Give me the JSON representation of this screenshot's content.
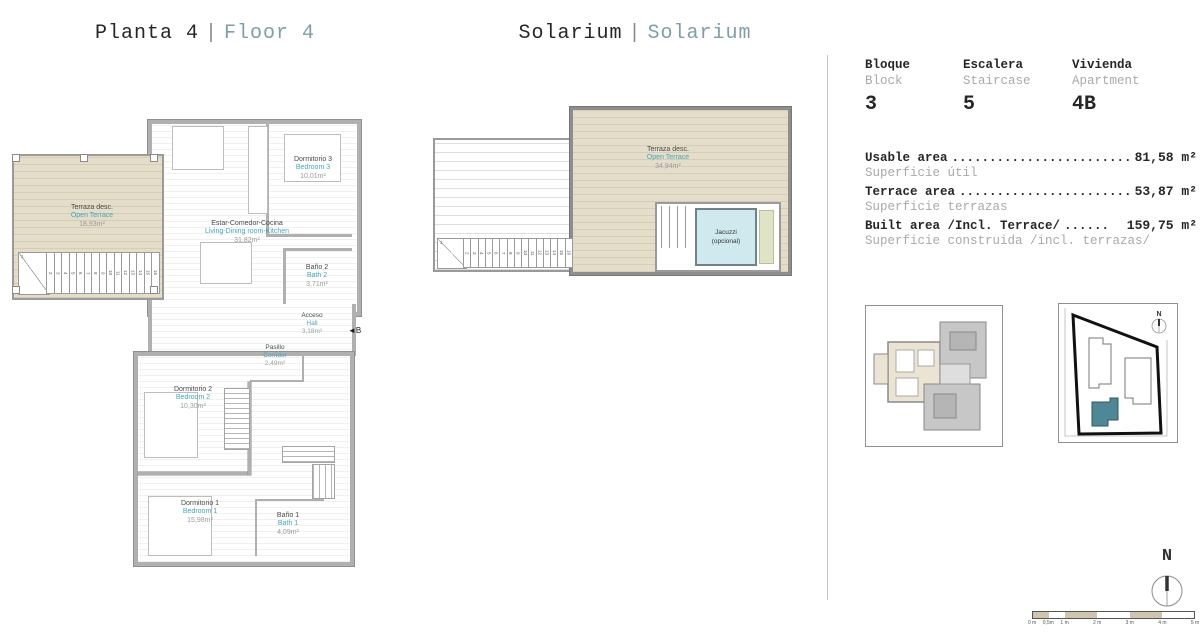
{
  "titles": {
    "floor": {
      "es": "Planta 4",
      "sep": "|",
      "en": "Floor 4"
    },
    "solarium": {
      "es": "Solarium",
      "sep": "|",
      "en": "Solarium"
    }
  },
  "unit_info": {
    "block": {
      "label_es": "Bloque",
      "label_en": "Block",
      "value": "3"
    },
    "staircase": {
      "label_es": "Escalera",
      "label_en": "Staircase",
      "value": "5"
    },
    "apartment": {
      "label_es": "Vivienda",
      "label_en": "Apartment",
      "value": "4B"
    }
  },
  "areas": [
    {
      "label_en": "Usable area",
      "dots": "........................",
      "value": "81,58 m²",
      "label_es": "Superficie útil"
    },
    {
      "label_en": "Terrace area",
      "dots": ".......................",
      "value": "53,87 m²",
      "label_es": "Superficie terrazas"
    },
    {
      "label_en": "Built area /Incl. Terrace/",
      "dots": "......",
      "value": "159,75 m²",
      "label_es": "Superficie construida /incl. terrazas/"
    }
  ],
  "floor_plan": {
    "rooms": {
      "terrace": {
        "es": "Terraza desc.",
        "en": "Open Terrace",
        "area": "18,93m²"
      },
      "living": {
        "es": "Estar-Comedor-Cocina",
        "en": "Living-Dining room-Kitchen",
        "area": "31,82m²"
      },
      "bedroom3": {
        "es": "Dormitorio 3",
        "en": "Bedroom 3",
        "area": "10,01m²"
      },
      "bath2": {
        "es": "Baño 2",
        "en": "Bath 2",
        "area": "3,71m²"
      },
      "hall": {
        "es": "Acceso",
        "en": "Hall",
        "area": "3,18m²"
      },
      "corridor": {
        "es": "Pasillo",
        "en": "Corridor",
        "area": "2,49m²"
      },
      "bedroom2": {
        "es": "Dormitorio 2",
        "en": "Bedroom 2",
        "area": "10,30m²"
      },
      "bedroom1": {
        "es": "Dormitorio 1",
        "en": "Bedroom 1",
        "area": "15,98m²"
      },
      "bath1": {
        "es": "Baño 1",
        "en": "Bath 1",
        "area": "4,09m²"
      }
    },
    "entrance_marker": "◄B",
    "stair_first": "1",
    "stair_numbers": [
      "2",
      "3",
      "4",
      "5",
      "6",
      "7",
      "8",
      "9",
      "10",
      "11",
      "12",
      "13",
      "14",
      "15",
      "16"
    ]
  },
  "solarium_plan": {
    "rooms": {
      "terrace": {
        "es": "Terraza desc.",
        "en": "Open Terrace",
        "area": "34,94m²"
      }
    },
    "jacuzzi": {
      "label": "Jacuzzi",
      "sub": "(opcional)"
    },
    "stair_first": "1",
    "stair_numbers": [
      "2",
      "3",
      "4",
      "5",
      "6",
      "7",
      "8",
      "9",
      "10",
      "11",
      "12",
      "13",
      "14",
      "15",
      "16"
    ]
  },
  "compass": {
    "label": "N"
  },
  "site_plan": {
    "compass": "N"
  },
  "scale_bar": {
    "labels": [
      "0 m",
      "0,5m",
      "1 m",
      "2 m",
      "3 m",
      "4 m",
      "5 m"
    ]
  },
  "colors": {
    "accent_teal": "#3fa9bd",
    "header_teal": "#7d9fa8",
    "deck_tan": "#e4ddca",
    "highlight_building": "#4e8796",
    "jacuzzi_blue": "#cfe9ee"
  }
}
